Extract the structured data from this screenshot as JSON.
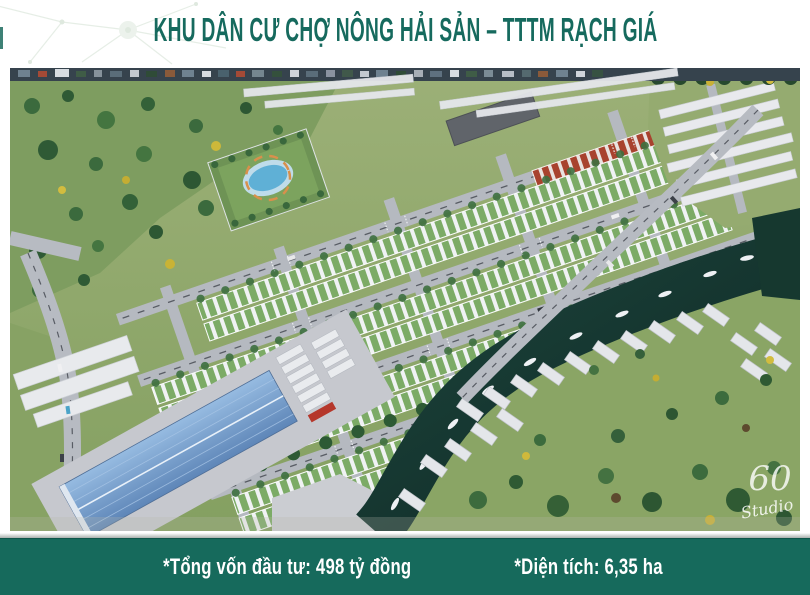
{
  "title": "KHU DÂN CƯ CHỢ NÔNG HẢI SẢN – TTTM RẠCH GIÁ",
  "footer": {
    "investment_label": "*Tổng vốn đầu tư: 498 tỷ đồng",
    "area_label": "*Diện tích: 6,35 ha"
  },
  "watermark": {
    "number": "60",
    "name": "Studio"
  },
  "colors": {
    "accent_teal": "#166a5c",
    "title_teal": "#166a5e",
    "river_dark_teal": "#13312c",
    "field_green": "#93a871",
    "market_roof_blue": "#7da3cf",
    "house_roof_green": "#7cab66",
    "house_roof_red": "#a8422e"
  }
}
